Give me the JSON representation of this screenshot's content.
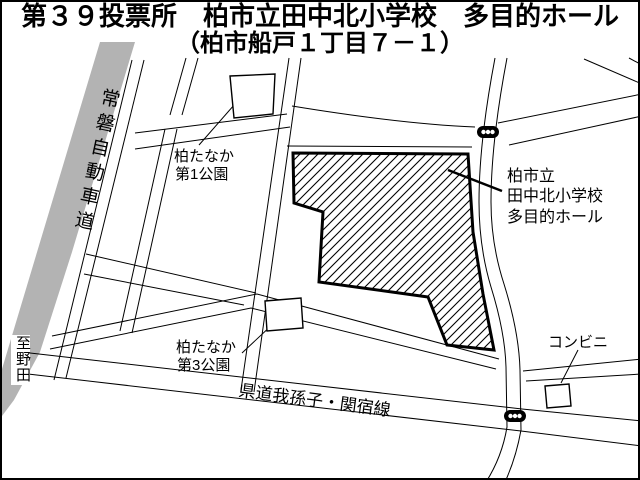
{
  "title": {
    "line1": "第３９投票所　柏市立田中北小学校　多目的ホール",
    "line2": "（柏市船戸１丁目７－１）"
  },
  "map": {
    "expressway_label": "常磐自動車道",
    "to_noda_label": "至野田",
    "park1_label": {
      "line1": "柏たなか",
      "line2": "第1公園"
    },
    "park3_label": {
      "line1": "柏たなか",
      "line2": "第3公園"
    },
    "school_label": {
      "line1": "柏市立",
      "line2": "田中北小学校",
      "line3": "多目的ホール"
    },
    "prefectural_road_label": "県道我孫子・関宿線",
    "convenience_store_label": "コンビニ",
    "colors": {
      "expressway_gray": "#b3b3b3",
      "line": "#000000",
      "background": "#ffffff"
    }
  }
}
